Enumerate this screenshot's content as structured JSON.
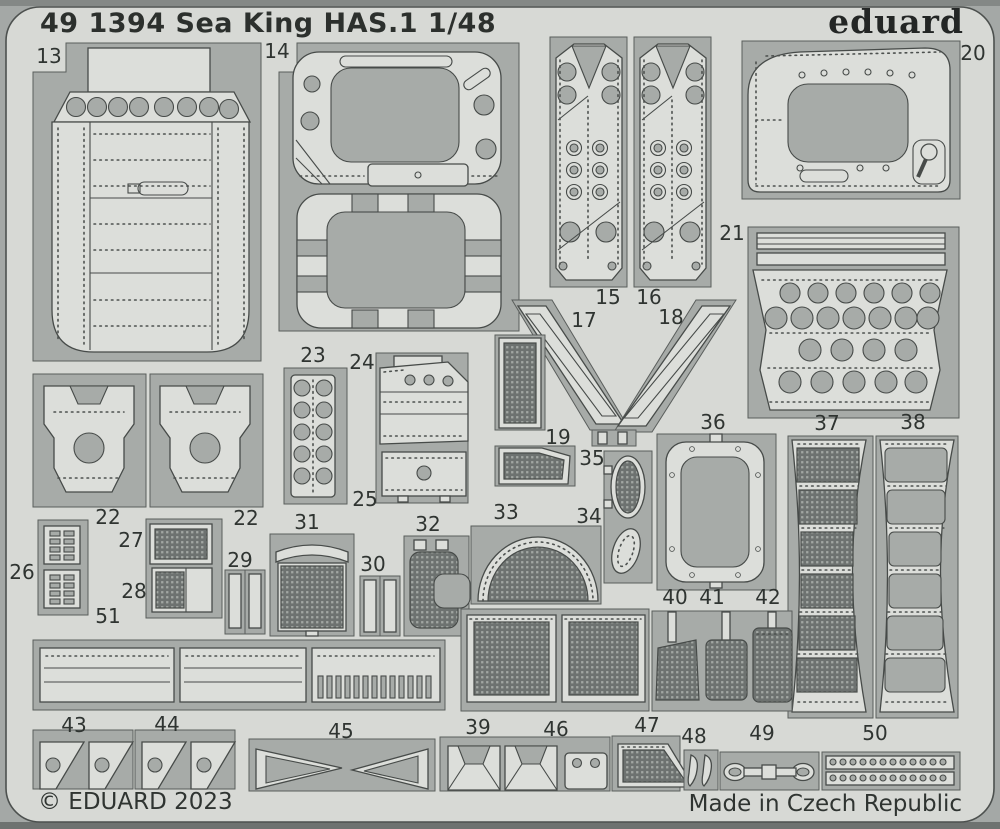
{
  "sheet": {
    "title": "49 1394 Sea King HAS.1 1/48",
    "brand": "eduard",
    "copyright": "© EDUARD 2023",
    "made_in": "Made in Czech Republic",
    "scale": "1/48",
    "subject": "Sea King HAS.1",
    "catalog_number": "49 1394"
  },
  "colors": {
    "fret_matrix": "#d7d9d5",
    "etched_window": "#a7aba8",
    "part_metal": "#dcdeda",
    "mesh_dark": "#6d7270",
    "outline": "#474b49",
    "text": "#2f3431",
    "photo_background": "#a4a8a6"
  },
  "parts": [
    {
      "id": "p13",
      "label": "13"
    },
    {
      "id": "p14",
      "label": "14"
    },
    {
      "id": "p15",
      "label": "15"
    },
    {
      "id": "p16",
      "label": "16"
    },
    {
      "id": "p17",
      "label": "17"
    },
    {
      "id": "p18",
      "label": "18"
    },
    {
      "id": "p19",
      "label": "19"
    },
    {
      "id": "p20",
      "label": "20"
    },
    {
      "id": "p21",
      "label": "21"
    },
    {
      "id": "p22a",
      "label": "22"
    },
    {
      "id": "p22b",
      "label": "22"
    },
    {
      "id": "p23",
      "label": "23"
    },
    {
      "id": "p24",
      "label": "24"
    },
    {
      "id": "p25",
      "label": "25"
    },
    {
      "id": "p26",
      "label": "26"
    },
    {
      "id": "p27",
      "label": "27"
    },
    {
      "id": "p28",
      "label": "28"
    },
    {
      "id": "p29",
      "label": "29"
    },
    {
      "id": "p30",
      "label": "30"
    },
    {
      "id": "p31",
      "label": "31"
    },
    {
      "id": "p32",
      "label": "32"
    },
    {
      "id": "p33",
      "label": "33"
    },
    {
      "id": "p34",
      "label": "34"
    },
    {
      "id": "p35",
      "label": "35"
    },
    {
      "id": "p36",
      "label": "36"
    },
    {
      "id": "p37",
      "label": "37"
    },
    {
      "id": "p38",
      "label": "38"
    },
    {
      "id": "p39",
      "label": "39"
    },
    {
      "id": "p40",
      "label": "40"
    },
    {
      "id": "p41",
      "label": "41"
    },
    {
      "id": "p42",
      "label": "42"
    },
    {
      "id": "p43",
      "label": "43"
    },
    {
      "id": "p44",
      "label": "44"
    },
    {
      "id": "p45",
      "label": "45"
    },
    {
      "id": "p46",
      "label": "46"
    },
    {
      "id": "p47",
      "label": "47"
    },
    {
      "id": "p48",
      "label": "48"
    },
    {
      "id": "p49",
      "label": "49"
    },
    {
      "id": "p50",
      "label": "50"
    },
    {
      "id": "p51",
      "label": "51"
    }
  ]
}
